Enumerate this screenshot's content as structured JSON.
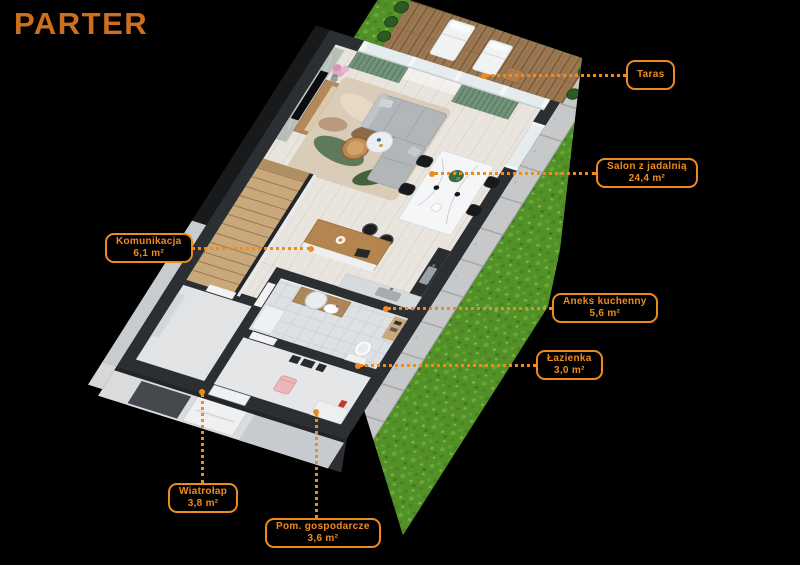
{
  "title": "PARTER",
  "colors": {
    "background": "#000000",
    "accent": "#ef8b1e",
    "title": "#cd6f1d",
    "grass": "#539128",
    "deck_wood": "#9b7851",
    "wall": "#2c2f32",
    "floor_wood": "#e9e5de",
    "curtain_green": "#6e8f75"
  },
  "rooms": [
    {
      "id": "taras",
      "name": "Taras",
      "area": "",
      "box": {
        "left": 626,
        "top": 60
      },
      "leader": {
        "x1": 486,
        "y1": 75,
        "x2": 626,
        "y2": 75
      },
      "dot": [
        484,
        76
      ]
    },
    {
      "id": "salon",
      "name": "Salon z jadalnią",
      "area": "24,4 m²",
      "box": {
        "left": 596,
        "top": 158
      },
      "leader": {
        "x1": 434,
        "y1": 173,
        "x2": 596,
        "y2": 173
      },
      "dot": [
        432,
        174
      ]
    },
    {
      "id": "komunikacja",
      "name": "Komunikacja",
      "area": "6,1 m²",
      "box": {
        "left": 105,
        "top": 233
      },
      "leader": {
        "x1": 179,
        "y1": 248,
        "x2": 310,
        "y2": 248
      },
      "dot": [
        311,
        249
      ]
    },
    {
      "id": "aneks-kuchenny",
      "name": "Aneks kuchenny",
      "area": "5,6 m²",
      "box": {
        "left": 552,
        "top": 293
      },
      "leader": {
        "x1": 388,
        "y1": 308,
        "x2": 552,
        "y2": 308
      },
      "dot": [
        386,
        309
      ]
    },
    {
      "id": "lazienka",
      "name": "Łazienka",
      "area": "3,0 m²",
      "box": {
        "left": 536,
        "top": 350
      },
      "leader": {
        "x1": 360,
        "y1": 365,
        "x2": 536,
        "y2": 365
      },
      "dot": [
        358,
        366
      ]
    },
    {
      "id": "wiatrolap",
      "name": "Wiatrołap",
      "area": "3,8 m²",
      "box": {
        "left": 168,
        "top": 483
      },
      "leader": {
        "x1": 202,
        "y1": 394,
        "x2": 202,
        "y2": 483
      },
      "dot": [
        202,
        392
      ]
    },
    {
      "id": "pom-gospodarcze",
      "name": "Pom. gospodarcze",
      "area": "3,6 m²",
      "box": {
        "left": 265,
        "top": 518
      },
      "leader": {
        "x1": 316,
        "y1": 414,
        "x2": 316,
        "y2": 518
      },
      "dot": [
        316,
        412
      ]
    }
  ]
}
